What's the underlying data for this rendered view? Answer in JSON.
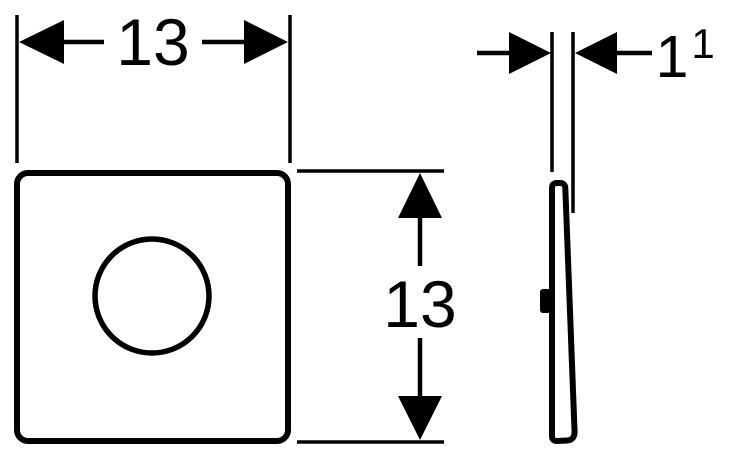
{
  "colors": {
    "line": "#000000",
    "background": "#ffffff"
  },
  "front_view": {
    "width_label": "13",
    "height_label": "13"
  },
  "side_view": {
    "thickness_label": "1",
    "thickness_footnote_superscript": "1"
  }
}
